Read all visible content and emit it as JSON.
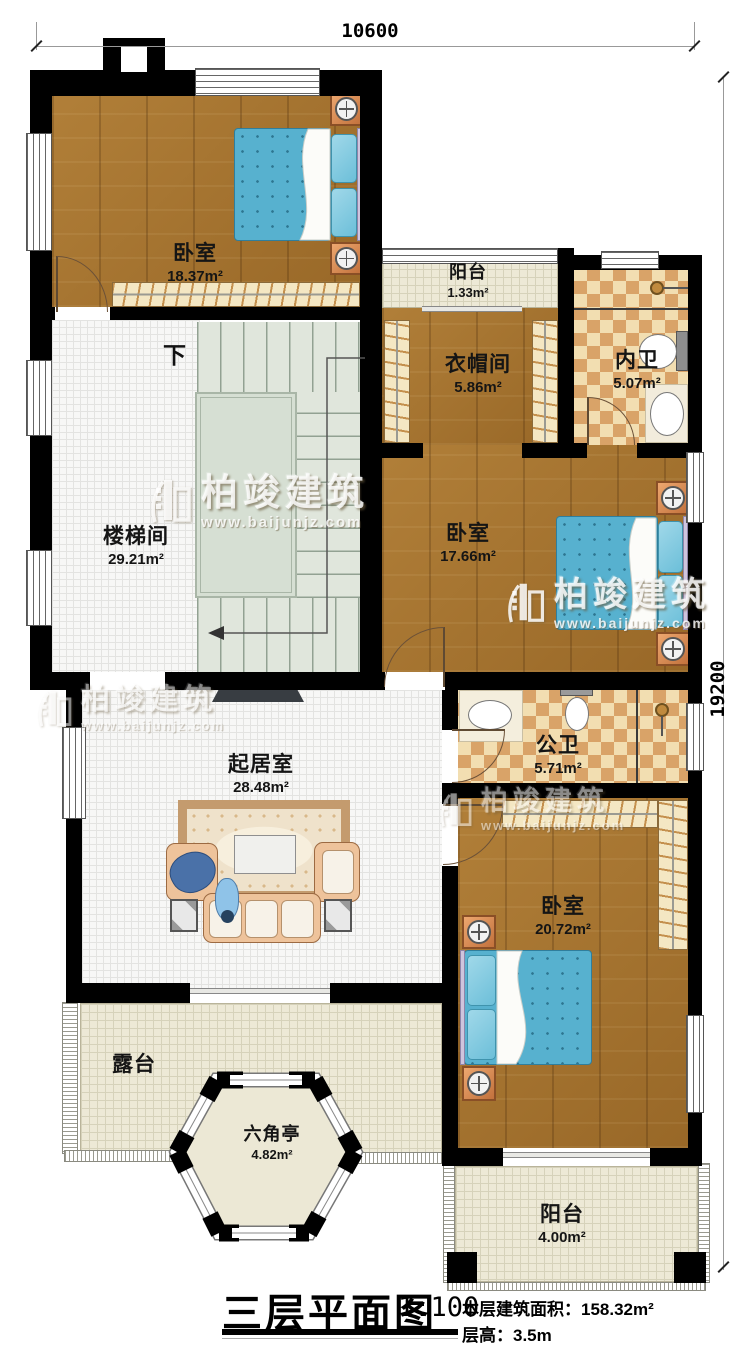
{
  "title_block": {
    "name": "三层平面图",
    "scale": "1:100",
    "area_label": "本层建筑面积：",
    "area_value": "158.32m²",
    "height_label": "层高：",
    "height_value": "3.5m"
  },
  "dimensions": {
    "top": "10600",
    "right": "19200"
  },
  "stair": {
    "down_label": "下"
  },
  "watermark": {
    "brand": "柏竣建筑",
    "url": "www.baijunjz.com"
  },
  "rooms": [
    {
      "id": "bedroom-nw",
      "name": "卧室",
      "area": "18.37m²"
    },
    {
      "id": "balcony-top",
      "name": "阳台",
      "area": "1.33m²"
    },
    {
      "id": "cloakroom",
      "name": "衣帽间",
      "area": "5.86m²"
    },
    {
      "id": "ensuite-bath",
      "name": "内卫",
      "area": "5.07m²"
    },
    {
      "id": "stair-hall",
      "name": "楼梯间",
      "area": "29.21m²"
    },
    {
      "id": "bedroom-mid",
      "name": "卧室",
      "area": "17.66m²"
    },
    {
      "id": "public-bath",
      "name": "公卫",
      "area": "5.71m²"
    },
    {
      "id": "living-room",
      "name": "起居室",
      "area": "28.48m²"
    },
    {
      "id": "bedroom-se",
      "name": "卧室",
      "area": "20.72m²"
    },
    {
      "id": "terrace",
      "name": "露台",
      "area": ""
    },
    {
      "id": "pavilion",
      "name": "六角亭",
      "area": "4.82m²"
    },
    {
      "id": "balcony-bottom",
      "name": "阳台",
      "area": "4.00m²"
    }
  ],
  "colors": {
    "wall": "#000000",
    "wood_floor": "#a8752f",
    "bed_blue": "#57b1cf",
    "checker_dark": "#d9a368",
    "checker_light": "#f2deb1",
    "balcony_floor": "#ede9d6",
    "stair_floor": "#e0e6dc"
  }
}
